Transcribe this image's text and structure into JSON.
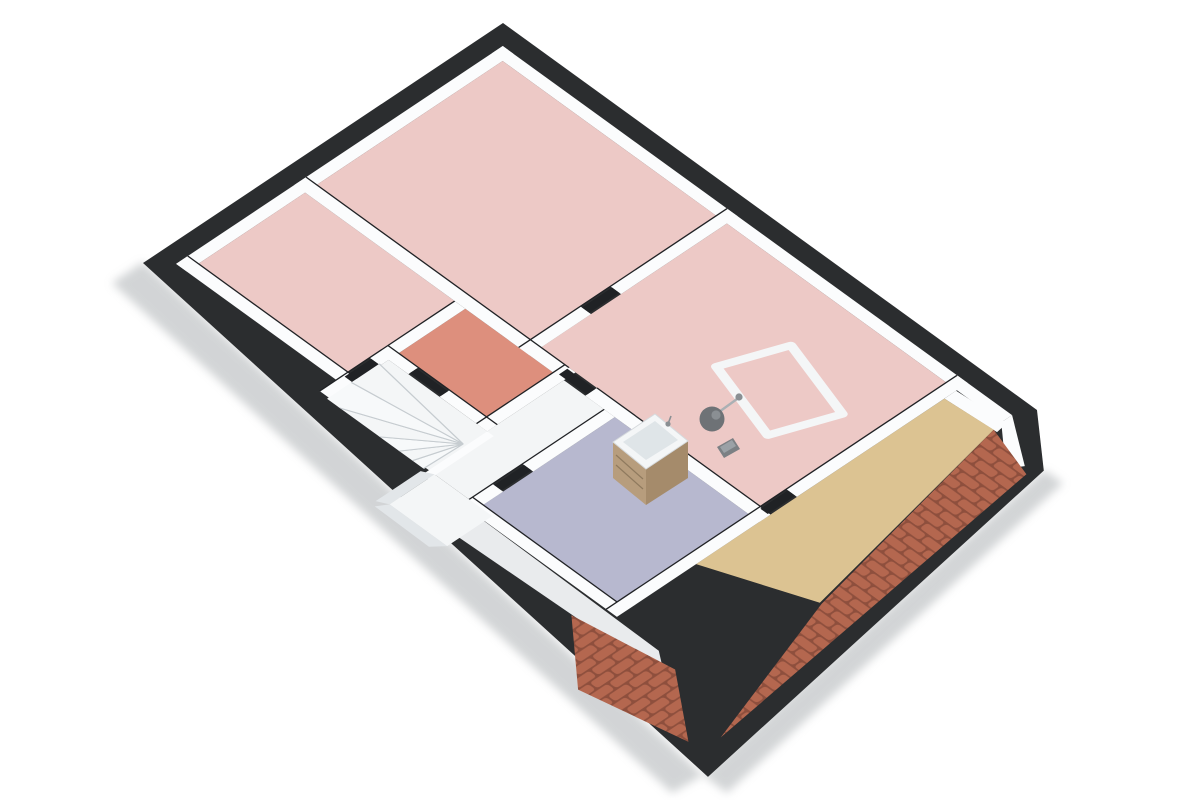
{
  "view": {
    "type": "3d-floor-plan",
    "projection": "isometric-birdseye",
    "floor": "attic-level",
    "background": "#ffffff"
  },
  "colors": {
    "background": "#ffffff",
    "structure_band": "#2b2d2f",
    "wall_white": "#fbfcfd",
    "wall_face": "#e2e6e9",
    "wall_edge": "#c6ccd0",
    "seam_dark": "#202225",
    "floor_pink": "#edc9c6",
    "floor_salmon": "#dd8f7d",
    "floor_lavender": "#b7b8cf",
    "floor_tan": "#dcc392",
    "floor_white": "#f3f5f6",
    "floor_strip": "#e9ebed",
    "tile_base": "#8e4f3d",
    "tile_top": "#b4674f",
    "shadow": "#aeb2b5",
    "wood_light": "#b79d7d",
    "wood_dark": "#a58b6b",
    "wood_line": "#8f7a5e",
    "fixture_white": "#f4f6f7",
    "basin_gray": "#dfe5e8",
    "lamp_gray": "#6e7276",
    "lamp_hi": "#8a8f93",
    "object_gray": "#7c8084",
    "step_fill": "#f7f9fa"
  },
  "rooms": [
    {
      "id": "bedroom-top-left",
      "type": "room",
      "floor_color_key": "floor_pink"
    },
    {
      "id": "bedroom-top-middle",
      "type": "room",
      "floor_color_key": "floor_pink"
    },
    {
      "id": "bedroom-right",
      "type": "room",
      "floor_color_key": "floor_pink"
    },
    {
      "id": "small-room-salmon",
      "type": "room",
      "floor_color_key": "floor_salmon"
    },
    {
      "id": "bathroom-lavender",
      "type": "room",
      "floor_color_key": "floor_lavender"
    },
    {
      "id": "hallway-stairwell",
      "type": "circulation",
      "floor_color_key": "floor_white"
    },
    {
      "id": "storage-tan-strip",
      "type": "storage",
      "floor_color_key": "floor_tan"
    },
    {
      "id": "eaves-strip",
      "type": "storage",
      "floor_color_key": "floor_strip"
    }
  ],
  "objects": [
    {
      "id": "winder-staircase",
      "location": "hallway-stairwell"
    },
    {
      "id": "vanity-cabinet-with-basin",
      "location": "bathroom-lavender"
    },
    {
      "id": "floor-lamp",
      "location": "bedroom-right"
    },
    {
      "id": "small-floor-object",
      "location": "bedroom-right"
    },
    {
      "id": "skylight-frame",
      "location": "bedroom-right"
    },
    {
      "id": "dormer-bump",
      "location": "lower-left-eave"
    },
    {
      "id": "roof-tiles-right-slope",
      "location": "right-eave"
    },
    {
      "id": "roof-tiles-bottom-slope",
      "location": "bottom-corner-eave"
    }
  ]
}
